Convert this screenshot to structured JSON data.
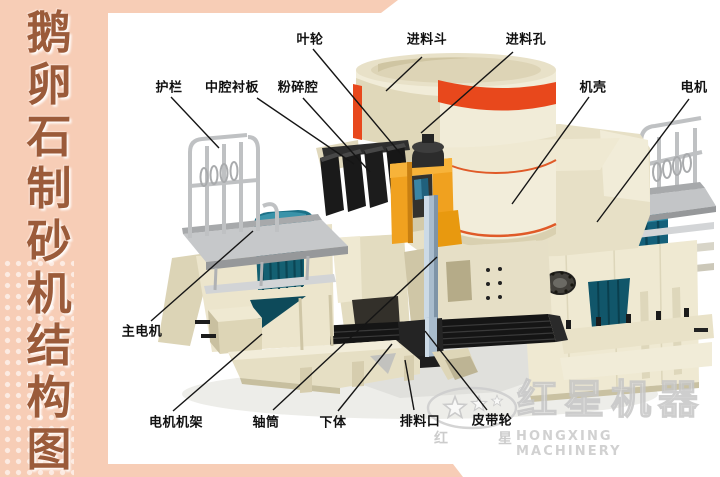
{
  "sidebar": {
    "title_chars": [
      "鹅",
      "卵",
      "石",
      "制",
      "砂",
      "机",
      "结",
      "构",
      "图"
    ]
  },
  "diagram": {
    "labels": [
      {
        "id": "impeller",
        "text": "叶轮"
      },
      {
        "id": "feed_hopper",
        "text": "进料斗"
      },
      {
        "id": "feed_hole",
        "text": "进料孔"
      },
      {
        "id": "guardrail",
        "text": "护栏"
      },
      {
        "id": "cavity_liner",
        "text": "中腔衬板"
      },
      {
        "id": "crushing_chamber",
        "text": "粉碎腔"
      },
      {
        "id": "casing",
        "text": "机壳"
      },
      {
        "id": "motor",
        "text": "电机"
      },
      {
        "id": "main_motor",
        "text": "主电机"
      },
      {
        "id": "motor_frame",
        "text": "电机机架"
      },
      {
        "id": "shaft_tube",
        "text": "轴筒"
      },
      {
        "id": "lower_body",
        "text": "下体"
      },
      {
        "id": "discharge_port",
        "text": "排料口"
      },
      {
        "id": "belt_pulley",
        "text": "皮带轮"
      }
    ]
  },
  "watermark": {
    "zh": "红星机器",
    "en": "HONGXING MACHINERY",
    "oval_left": "红",
    "oval_right": "星",
    "registered": "®"
  },
  "colors": {
    "frame_peach": "#f7cdb6",
    "sidebar_text": "#9b5b3a",
    "machine_cream": "#efe9d2",
    "accent_red": "#e8481c",
    "accent_orange": "#f0a11f",
    "motor_teal": "#156575",
    "liner_black": "#1a1a1a",
    "platform_gray": "#c3c5c7",
    "label_text": "#111111",
    "watermark_gray": "#c8c8c8"
  }
}
